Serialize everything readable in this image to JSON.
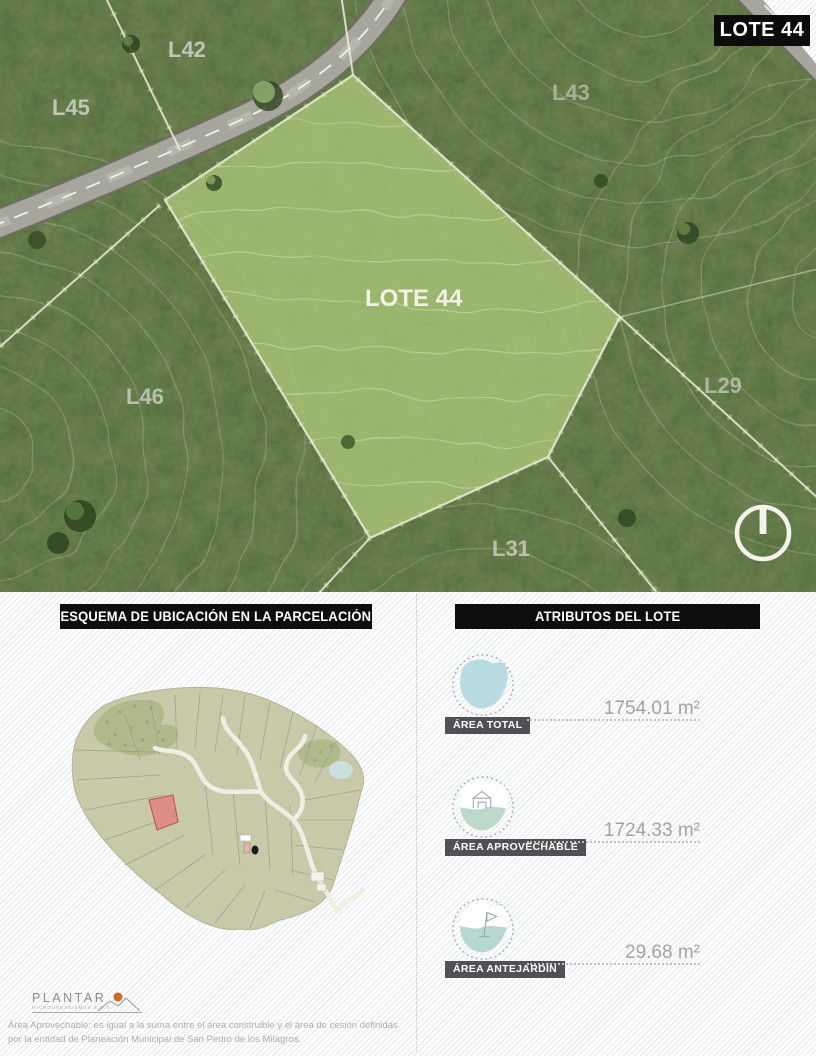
{
  "badge": {
    "label": "LOTE 44"
  },
  "aerial": {
    "labels": [
      {
        "id": "l42",
        "text": "L42"
      },
      {
        "id": "l45",
        "text": "L45"
      },
      {
        "id": "l43",
        "text": "L43"
      },
      {
        "id": "lote44",
        "text": "LOTE 44"
      },
      {
        "id": "l46",
        "text": "L46"
      },
      {
        "id": "l29",
        "text": "L29"
      },
      {
        "id": "l31",
        "text": "L31"
      }
    ]
  },
  "location_panel": {
    "header": "ESQUEMA DE UBICACIÓN EN LA PARCELACIÓN"
  },
  "attributes_panel": {
    "header": "ATRIBUTOS DEL LOTE",
    "items": [
      {
        "label": "ÁREA TOTAL",
        "value": "1754.01 m²",
        "icon": "area-total-blob-icon"
      },
      {
        "label": "ÁREA APROVECHABLE",
        "value": "1724.33 m²",
        "icon": "area-aprovechable-house-icon"
      },
      {
        "label": "ÁREA ANTEJARDÍN",
        "value": "29.68 m²",
        "icon": "area-antejardin-flag-icon"
      }
    ]
  },
  "footer": {
    "brand": "PLANTAR",
    "brand_sub": "MICROURBANISMOS S.A.S.",
    "disclaimer": "Área Aprovechable: es igual a la suma entre el área construible y el área de cesión definidas por la entidad de Planeación Municipal de San Pedro de los Milagros."
  },
  "colors": {
    "badge_black": "#0b0b0b",
    "label_bar_gray": "#515155",
    "value_gray": "#a2a2a2",
    "lot_highlight_green": "#a9c678",
    "attr_blob_blue": "#b9dce2",
    "red_lot_marker": "#db8d86",
    "sun_orange": "#cf6a2e"
  }
}
